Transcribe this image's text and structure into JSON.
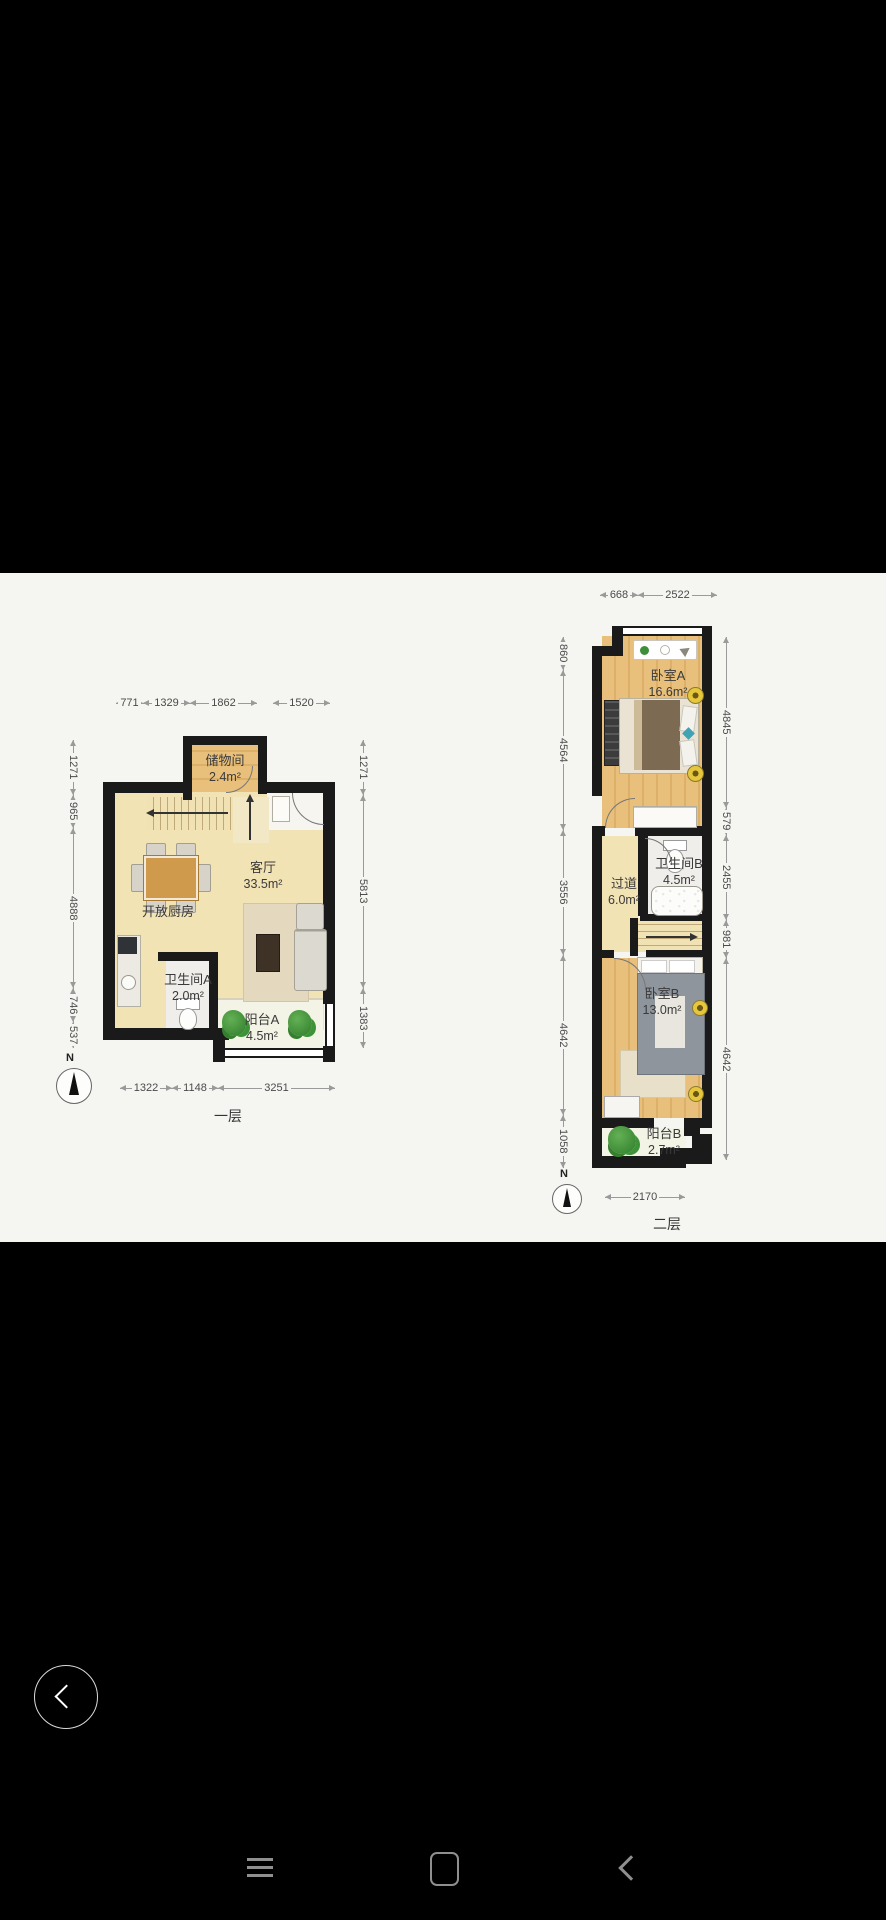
{
  "viewer": {
    "back_button_icon": "chevron-left",
    "nav_bar": {
      "menu_icon": "hamburger-lines",
      "home_icon": "rounded-square",
      "back_icon": "chevron-left"
    }
  },
  "colors": {
    "background": "#000000",
    "panel": "#f5f5f2",
    "wall": "#1a1a1a",
    "wood_floor": "#e6bd78",
    "main_floor": "#f2e3b4",
    "balcony_floor": "#f3f4e6",
    "plant_green": "#3e8f3a",
    "dim_text": "#4a4a4a"
  },
  "floorplans": [
    {
      "floor_label": "一层",
      "compass_label": "N",
      "rooms": [
        {
          "name": "储物间",
          "area": "2.4m²"
        },
        {
          "name": "客厅",
          "area": "33.5m²"
        },
        {
          "name": "开放厨房",
          "area": ""
        },
        {
          "name": "卫生间A",
          "area": "2.0m²"
        },
        {
          "name": "阳台A",
          "area": "4.5m²"
        }
      ],
      "dims": {
        "top": [
          "771",
          "1329",
          "1862",
          "1520"
        ],
        "left": [
          "1271",
          "965",
          "4888",
          "746",
          "537"
        ],
        "right": [
          "1271",
          "5813",
          "1383"
        ],
        "bottom": [
          "1322",
          "1148",
          "3251"
        ]
      }
    },
    {
      "floor_label": "二层",
      "compass_label": "N",
      "rooms": [
        {
          "name": "卧室A",
          "area": "16.6m²"
        },
        {
          "name": "卫生间B",
          "area": "4.5m²"
        },
        {
          "name": "过道",
          "area": "6.0m²"
        },
        {
          "name": "卧室B",
          "area": "13.0m²"
        },
        {
          "name": "阳台B",
          "area": "2.7m²"
        }
      ],
      "dims": {
        "top": [
          "668",
          "2522"
        ],
        "left": [
          "860",
          "4564",
          "3556",
          "4642",
          "1058"
        ],
        "right": [
          "4845",
          "579",
          "2455",
          "981",
          "4642"
        ],
        "bottom": [
          "2170"
        ]
      }
    }
  ]
}
